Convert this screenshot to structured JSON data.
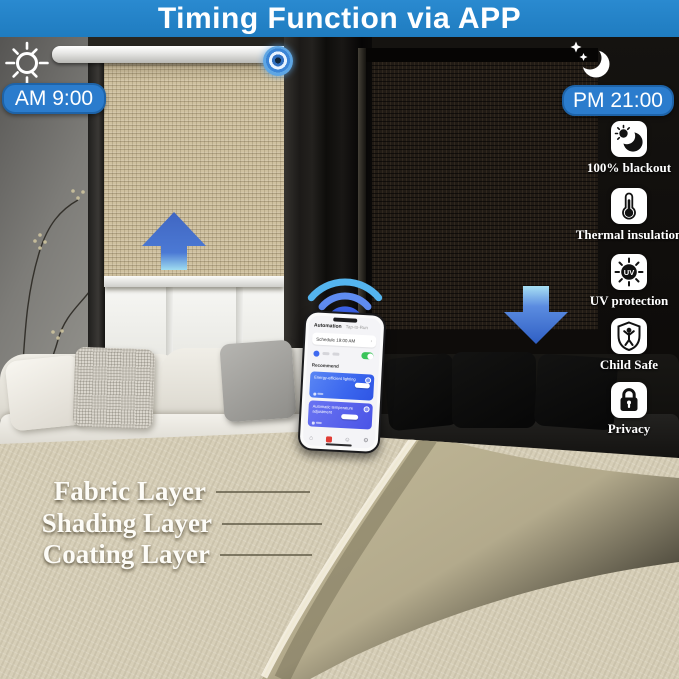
{
  "banner": {
    "title": "Timing Function via APP"
  },
  "day": {
    "time_label": "AM 9:00"
  },
  "night": {
    "time_label": "PM 21:00"
  },
  "features": [
    {
      "icon": "blackout-moon-icon",
      "label": "100% blackout"
    },
    {
      "icon": "thermometer-icon",
      "label": "Thermal insulation"
    },
    {
      "icon": "uv-sun-icon",
      "label": "UV protection"
    },
    {
      "icon": "child-safe-shield-icon",
      "label": "Child Safe"
    },
    {
      "icon": "privacy-lock-icon",
      "label": "Privacy"
    }
  ],
  "fabric_layers": [
    {
      "label": "Fabric Layer"
    },
    {
      "label": "Shading Layer"
    },
    {
      "label": "Coating Layer"
    }
  ],
  "phone_app": {
    "tabs": {
      "automation": "Automation",
      "tap_to_run": "Tap-to-Run"
    },
    "schedule_card": "Schedule 19:00 AM",
    "chevron": "›",
    "recommend": "Recommend",
    "cards": [
      {
        "title": "Energy-efficient lighting"
      },
      {
        "title": "Automatic temperature adjustment"
      }
    ]
  },
  "icons": {
    "uv_text": "UV"
  },
  "colors": {
    "banner_blue": "#1f7cc0",
    "badge_blue": "#2b7ccd",
    "arrow_blue": "#3f6fca",
    "wifi_blue": "#54b0ee",
    "app_blue": "#3f6af0",
    "toggle_green": "#3ac45a",
    "blind_tan": "#cfc1a0",
    "fabric_beige": "#d7cfb8",
    "fold_khaki": "#b3aa8c",
    "night_black": "#0b0908"
  }
}
